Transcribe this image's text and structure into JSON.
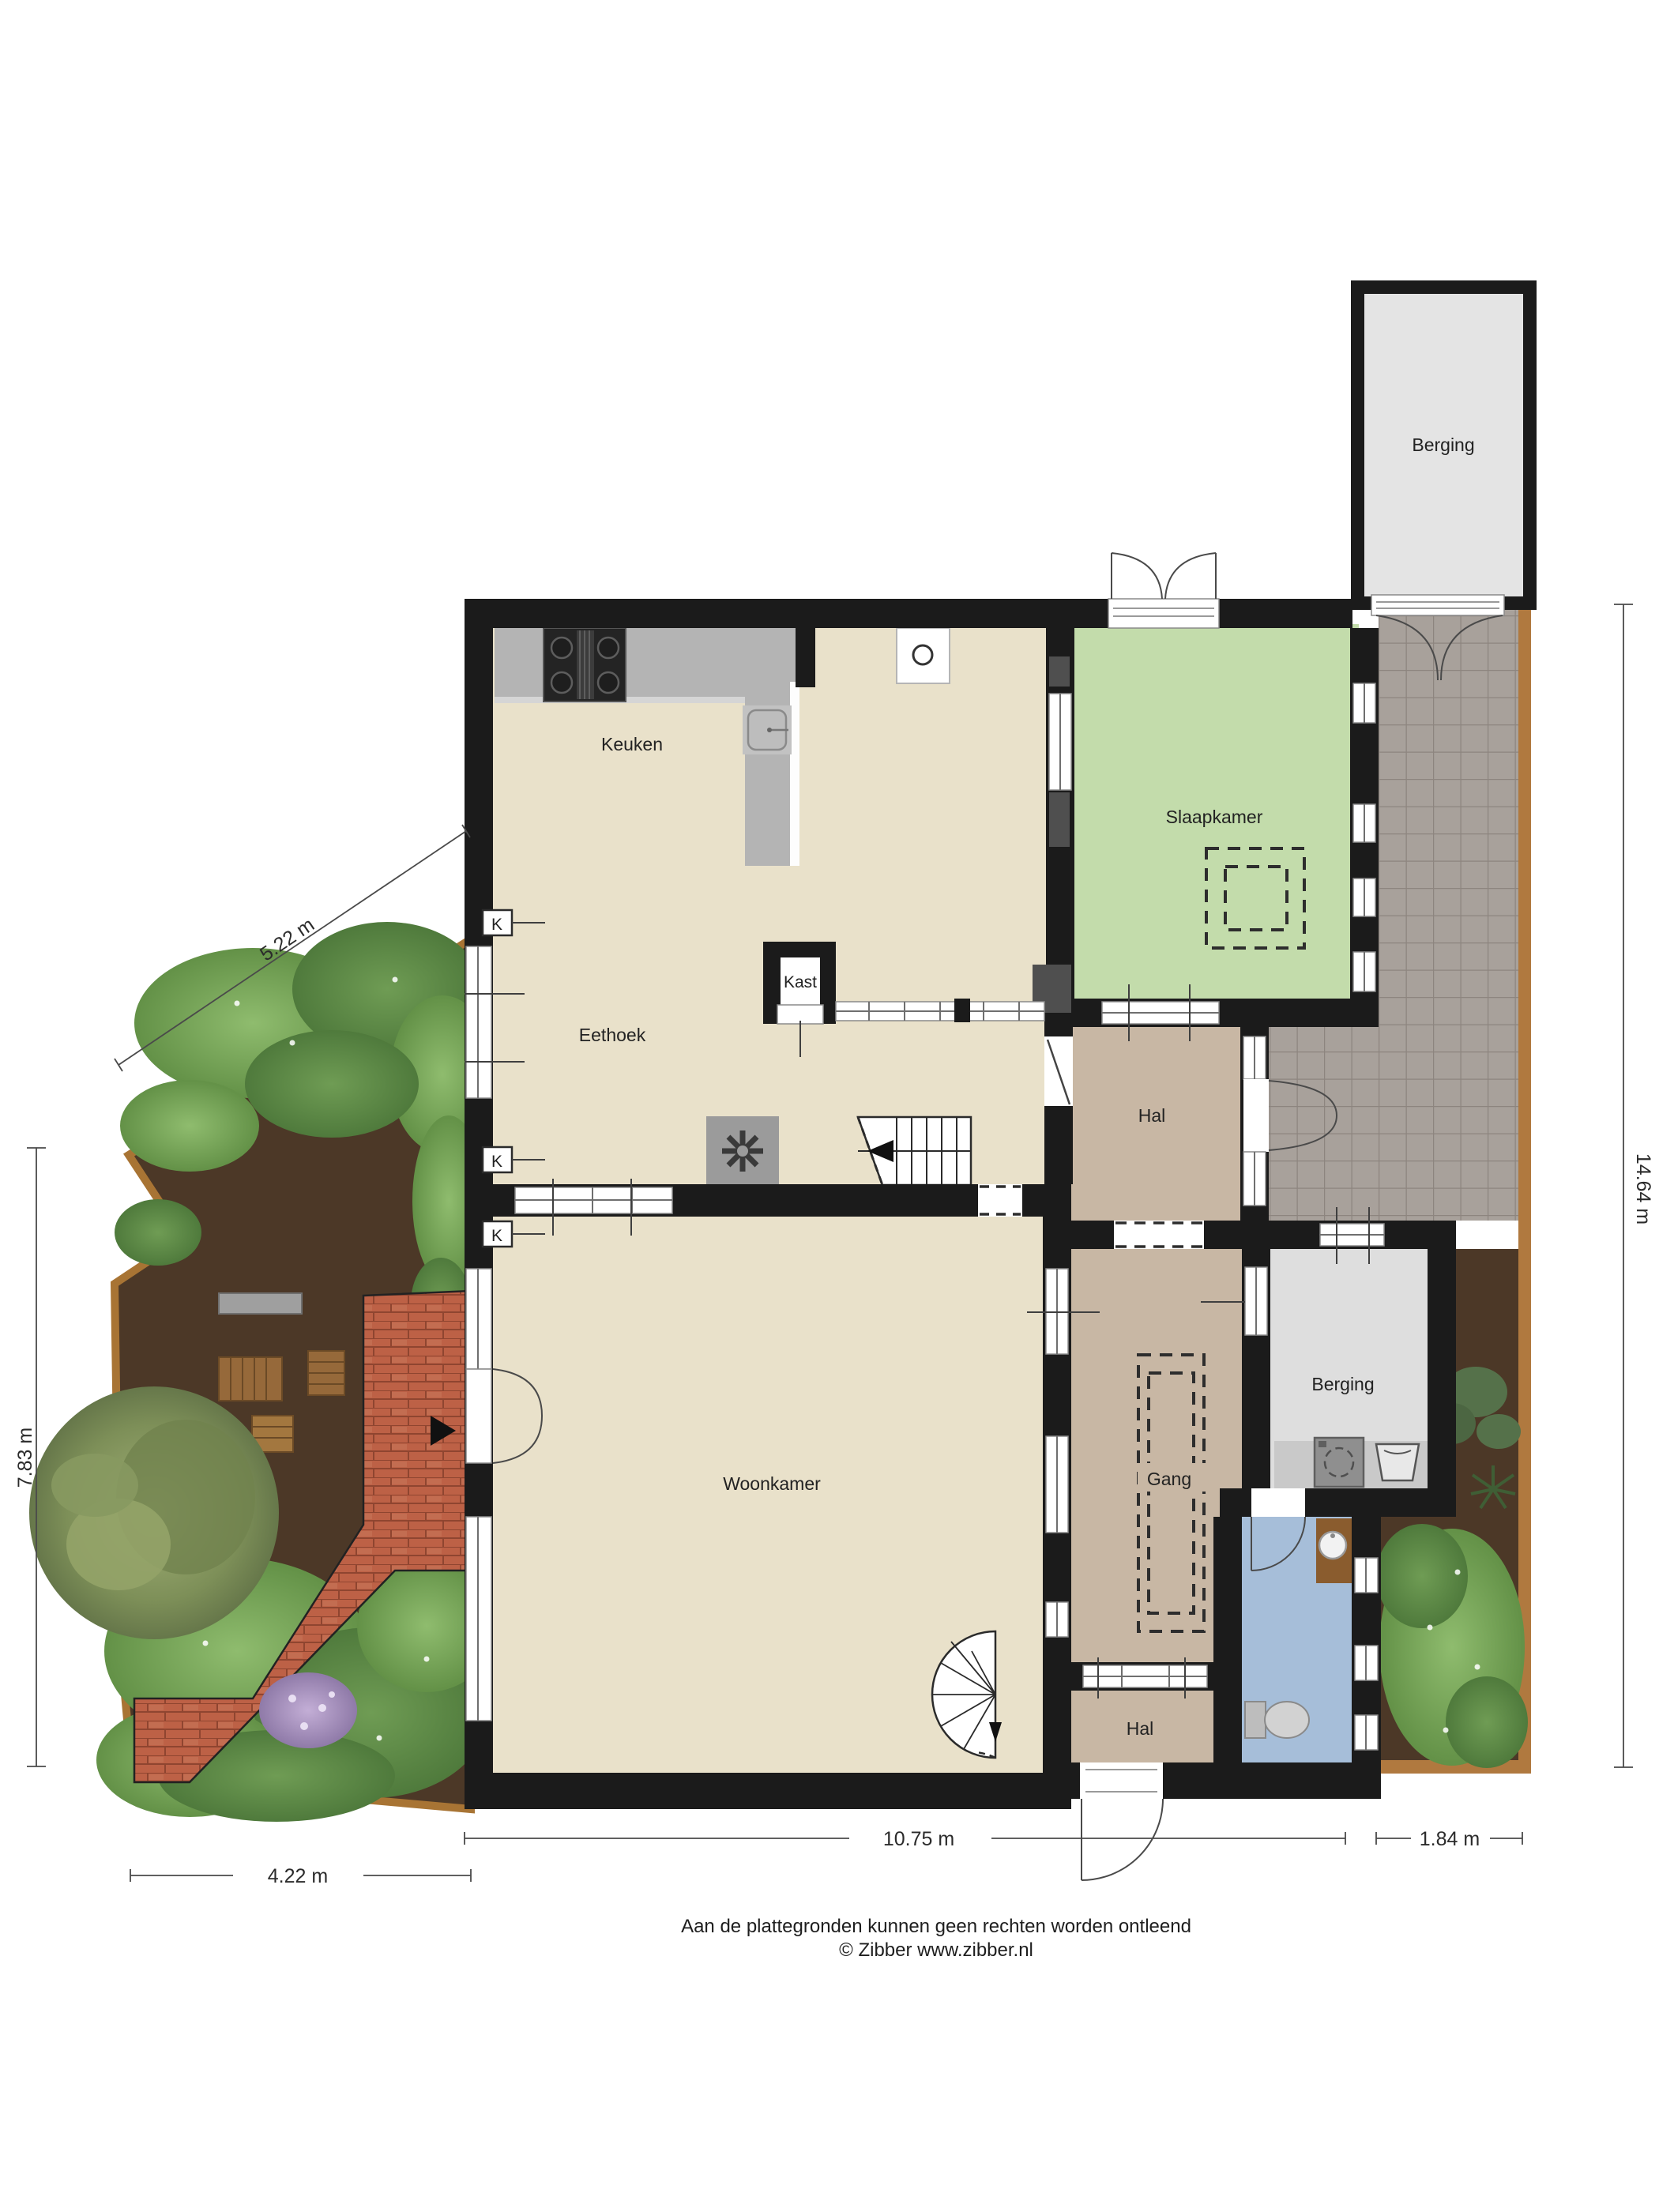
{
  "rooms": {
    "keuken": "Keuken",
    "eethoek": "Eethoek",
    "kast": "Kast",
    "slaapkamer": "Slaapkamer",
    "hal_midden": "Hal",
    "woonkamer": "Woonkamer",
    "gang": "Gang",
    "berging_binnen": "Berging",
    "hal_entree": "Hal",
    "berging_schuur": "Berging"
  },
  "markers": {
    "kolom": "K"
  },
  "dimensions": {
    "garden_diagonal": "5.22 m",
    "garden_left_vertical": "7.83 m",
    "right_vertical": "14.64 m",
    "bottom_left": "4.22 m",
    "bottom_middle": "10.75 m",
    "bottom_right": "1.84 m"
  },
  "footer": {
    "line1": "Aan de plattegronden kunnen geen rechten worden ontleend",
    "line2": "© Zibber www.zibber.nl"
  },
  "colors": {
    "wall": "#1b1b1b",
    "floor_living": "#e9e1ca",
    "floor_bedroom": "#c3dcab",
    "floor_hall": "#c8b7a4",
    "floor_storage": "#dedede",
    "floor_toilet": "#a6bed9",
    "patio_tile": "#a8a19b",
    "garden_soil": "#4c3827",
    "garden_bush": "#76a55a",
    "wood_edge": "#a87434",
    "brick_path": "#bd6342",
    "counter": "#b4b4b4"
  }
}
